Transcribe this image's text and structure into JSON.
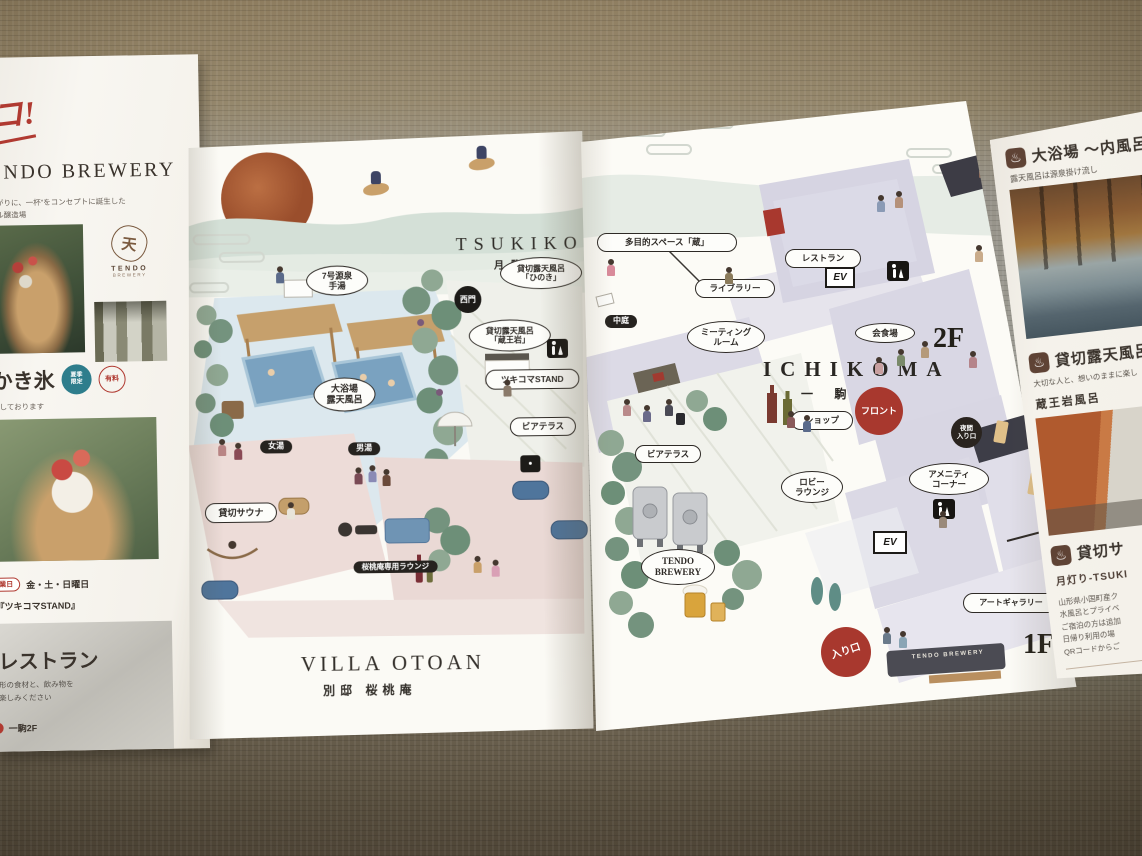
{
  "palette": {
    "accent_red": "#a8382e",
    "label_ink": "#2e2a26",
    "lavender": "#d8d6e3",
    "bath_blue": "#dce8ee",
    "pool_blue": "#7aa2c0",
    "villa_pink": "#ecdcd8",
    "paper": "#fbfaf5",
    "tatami_gray": "#9b9a92",
    "carpet_brown": "#8d7c5e"
  },
  "left_panel": {
    "script": "コ!",
    "brewery_title": "TENDO BREWERY",
    "brewery_desc1": "あがりに、一杯”をコンセプトに誕生した",
    "brewery_desc2": "ール醸造場",
    "logo_kanji": "天",
    "logo_en1": "TENDO",
    "logo_en2": "BREWERY",
    "kakigori_title": "かき氷",
    "badge_season1": "夏季",
    "badge_season2": "限定",
    "badge_paid": "有料",
    "kakigori_note": "売しております",
    "schedule_badge": "営業日",
    "schedule_days": "金・土・日曜日",
    "stand_name": "『ツキコマSTAND』",
    "restaurant_title": "レストラン",
    "restaurant_desc1": "形の食材と、飲み物を",
    "restaurant_desc2": "楽しみください",
    "restaurant_floor": "一駒2F"
  },
  "tsukikoma": {
    "title_en": "TSUKIKOMA",
    "title_ja": "月駒",
    "label_gensen1": "7号源泉",
    "label_gensen2": "手湯",
    "label_hinoki1": "貸切露天風呂",
    "label_hinoki2": "「ひのき」",
    "label_zao1": "貸切露天風呂",
    "label_zao2": "「蔵王岩」",
    "label_west_gate": "西門",
    "label_daiyokujo1": "大浴場",
    "label_daiyokujo2": "露天風呂",
    "label_onna": "女湯",
    "label_otoko": "男湯",
    "label_sauna": "貸切サウナ",
    "label_stand": "ツキコマSTAND",
    "label_beer_terrace": "ビアテラス",
    "label_lounge": "桜桃庵専用ラウンジ",
    "villa_en": "VILLA OTOAN",
    "villa_ja": "別邸 桜桃庵"
  },
  "ichikoma": {
    "title_en": "ICHIKOMA",
    "title_ja": "一 駒",
    "floor2_label": "2F",
    "floor1_label": "1F",
    "label_multi": "多目的スペース「蔵」",
    "label_restaurant": "レストラン",
    "label_library": "ライブラリー",
    "label_meeting1": "ミーティング",
    "label_meeting2": "ルーム",
    "label_ev": "EV",
    "label_banquet": "会食場",
    "label_courtyard": "中庭",
    "label_shop": "ショップ",
    "label_front": "フロント",
    "label_night1": "夜間",
    "label_night2": "入り口",
    "label_beer_terrace": "ビアテラス",
    "label_lobby1": "ロビー",
    "label_lobby2": "ラウンジ",
    "label_amenity1": "アメニティ",
    "label_amenity2": "コーナー",
    "label_gallery": "アートギャラリー",
    "label_entrance": "入り口",
    "label_brewery1": "TENDO",
    "label_brewery2": "BREWERY",
    "sign_text": "TENDO BREWERY"
  },
  "right_panel": {
    "onsen_icon": "♨",
    "s1_title": "大浴場 〜内風呂・露",
    "s1_sub": "露天風呂は源泉掛け流し",
    "s2_title": "貸切露天風呂",
    "s2_sub": "大切な人と、想いのままに楽し",
    "s2_item": "蔵王岩風呂",
    "s3_title": "貸切サ",
    "s3_sub": "月灯り-TSUKI",
    "s3_line1": "山形県小国町産ク",
    "s3_line2": "水風呂とプライベ",
    "s3_line3": "ご宿泊の方は追加",
    "s3_line4": "日帰り利用の場",
    "s3_line5": "QRコードからご"
  }
}
